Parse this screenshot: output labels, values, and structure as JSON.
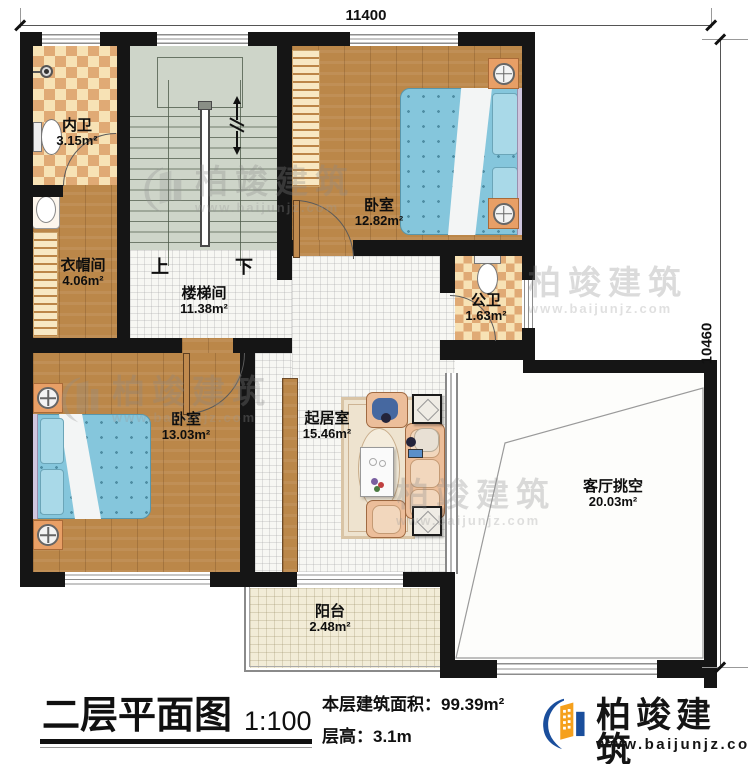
{
  "dimensions": {
    "width_mm": "11400",
    "height_mm": "10460"
  },
  "rooms": {
    "inner_bath": {
      "name": "内卫",
      "area": "3.15m²"
    },
    "bedroom_top": {
      "name": "卧室",
      "area": "12.82m²"
    },
    "cloakroom": {
      "name": "衣帽间",
      "area": "4.06m²"
    },
    "stairwell": {
      "name": "楼梯间",
      "area": "11.38m²"
    },
    "public_bath": {
      "name": "公卫",
      "area": "1.63m²"
    },
    "bedroom_left": {
      "name": "卧室",
      "area": "13.03m²"
    },
    "living_room": {
      "name": "起居室",
      "area": "15.46m²"
    },
    "void": {
      "name": "客厅挑空",
      "area": "20.03m²"
    },
    "balcony": {
      "name": "阳台",
      "area": "2.48m²"
    }
  },
  "stairs": {
    "up_label": "上",
    "down_label": "下"
  },
  "title_block": {
    "title": "二层平面图",
    "scale": "1:100",
    "floor_area": "本层建筑面积：99.39m²",
    "floor_height": "层高：3.1m"
  },
  "brand": {
    "name": "柏竣建筑",
    "website": "www.baijunjz.com"
  },
  "watermark": {
    "name": "柏竣建筑",
    "website": "www.baijunjz.com"
  },
  "colors": {
    "wall": "#151515",
    "wood": "#bb8749",
    "tile": "#f7f7f3",
    "checker_dark": "#e0aa75",
    "checker_light": "#f7e2b5",
    "stair": "#ced5c9",
    "bed": "#85c6dc",
    "balcony_floor": "#f2ecd7",
    "logo_blue": "#1a4e9c",
    "logo_orange": "#f5a01c"
  }
}
